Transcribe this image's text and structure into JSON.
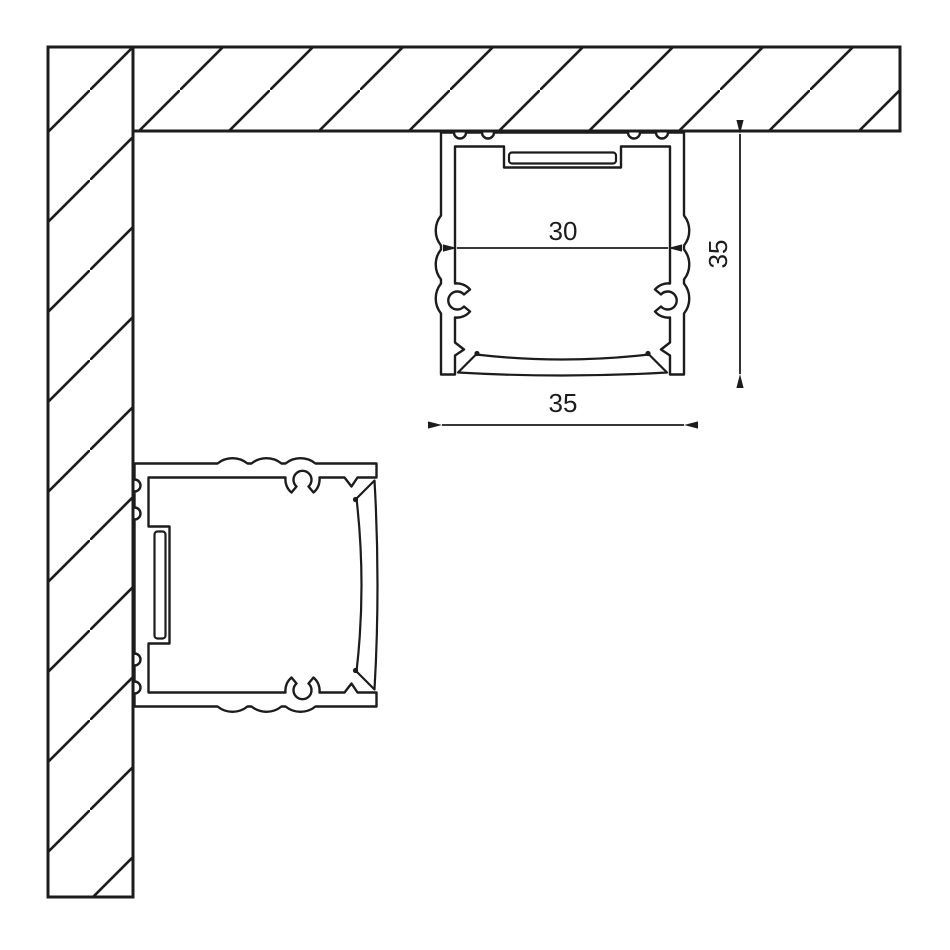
{
  "diagram": {
    "type": "technical-cross-section",
    "subject": "Aluminium LED strip profile mounting drawing (ceiling mount and wall mount)",
    "colors": {
      "background": "#ffffff",
      "line": "#1c1c1c"
    },
    "dimensions": {
      "inner_width": "30",
      "profile_height": "35",
      "profile_width": "35"
    },
    "elements": {
      "wall": "hatched wall section (left, vertical)",
      "ceiling": "hatched ceiling section (top, horizontal)",
      "ceiling_profile": "profile cross-section mounted to ceiling, diffuser facing down",
      "wall_profile": "profile cross-section mounted to wall, diffuser facing right"
    }
  }
}
